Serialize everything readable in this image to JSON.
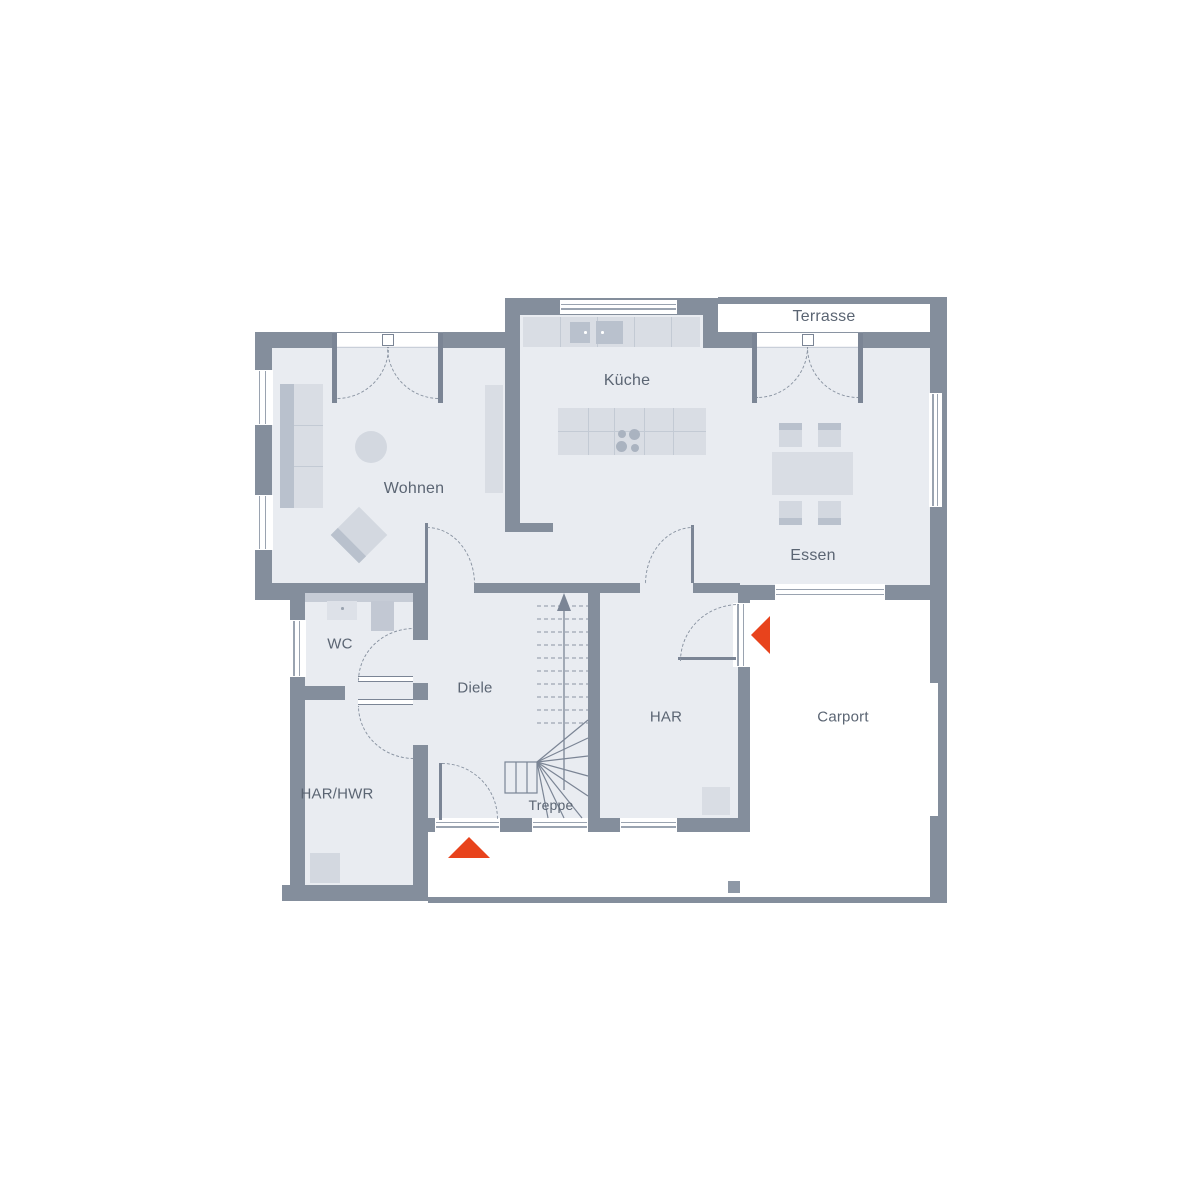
{
  "plan": {
    "title": "Erdgeschoss Grundriss",
    "rooms": [
      {
        "id": "terrasse",
        "label": "Terrasse"
      },
      {
        "id": "kueche",
        "label": "Küche"
      },
      {
        "id": "wohnen",
        "label": "Wohnen"
      },
      {
        "id": "essen",
        "label": "Essen"
      },
      {
        "id": "wc",
        "label": "WC"
      },
      {
        "id": "diele",
        "label": "Diele"
      },
      {
        "id": "har",
        "label": "HAR"
      },
      {
        "id": "carport",
        "label": "Carport"
      },
      {
        "id": "har_hwr",
        "label": "HAR/HWR"
      },
      {
        "id": "treppe",
        "label": "Treppe"
      }
    ],
    "entrance_arrows": [
      {
        "id": "main-entrance",
        "direction": "up"
      },
      {
        "id": "side-entrance",
        "direction": "left"
      }
    ],
    "colors": {
      "wall": "#848e9c",
      "floor": "#e9ecf1",
      "furniture_light": "#d9dde4",
      "furniture_mid": "#d3d8e0",
      "furniture_dark": "#b9c1cd",
      "line": "#7b8595",
      "dashed_line": "#8a94a2",
      "label_text": "#5b6573",
      "accent": "#e8431c"
    }
  }
}
